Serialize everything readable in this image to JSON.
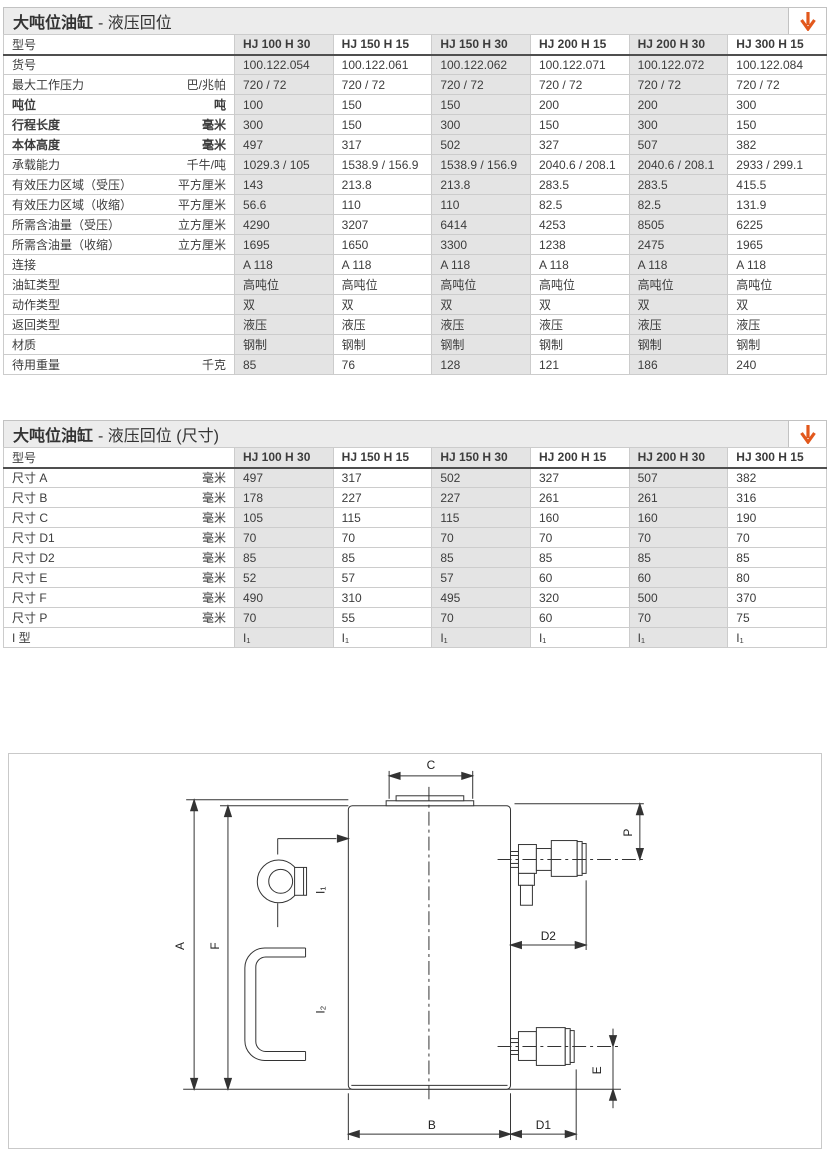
{
  "accent_orange": "#e2581c",
  "tables": [
    {
      "title_main": "大吨位油缸",
      "title_suffix": "- 液压回位",
      "model_header": "型号",
      "columns": [
        "HJ 100 H 30",
        "HJ 150 H 15",
        "HJ 150 H 30",
        "HJ 200 H 15",
        "HJ 200 H 30",
        "HJ 300 H 15"
      ],
      "rows": [
        {
          "label": "货号",
          "unit": "",
          "bold": false,
          "values": [
            "100.122.054",
            "100.122.061",
            "100.122.062",
            "100.122.071",
            "100.122.072",
            "100.122.084"
          ]
        },
        {
          "label": "最大工作压力",
          "unit": "巴/兆帕",
          "bold": false,
          "values": [
            "720 / 72",
            "720 / 72",
            "720 / 72",
            "720 / 72",
            "720 / 72",
            "720 / 72"
          ]
        },
        {
          "label": "吨位",
          "unit": "吨",
          "bold": true,
          "values": [
            "100",
            "150",
            "150",
            "200",
            "200",
            "300"
          ]
        },
        {
          "label": "行程长度",
          "unit": "毫米",
          "bold": true,
          "values": [
            "300",
            "150",
            "300",
            "150",
            "300",
            "150"
          ]
        },
        {
          "label": "本体高度",
          "unit": "毫米",
          "bold": true,
          "values": [
            "497",
            "317",
            "502",
            "327",
            "507",
            "382"
          ]
        },
        {
          "label": "承载能力",
          "unit": "千牛/吨",
          "bold": false,
          "values": [
            "1029.3 / 105",
            "1538.9 / 156.9",
            "1538.9 / 156.9",
            "2040.6 / 208.1",
            "2040.6 / 208.1",
            "2933 / 299.1"
          ]
        },
        {
          "label": "有效压力区域（受压）",
          "unit": "平方厘米",
          "bold": false,
          "values": [
            "143",
            "213.8",
            "213.8",
            "283.5",
            "283.5",
            "415.5"
          ]
        },
        {
          "label": "有效压力区域（收缩）",
          "unit": "平方厘米",
          "bold": false,
          "values": [
            "56.6",
            "110",
            "110",
            "82.5",
            "82.5",
            "131.9"
          ]
        },
        {
          "label": "所需含油量（受压）",
          "unit": "立方厘米",
          "bold": false,
          "values": [
            "4290",
            "3207",
            "6414",
            "4253",
            "8505",
            "6225"
          ]
        },
        {
          "label": "所需含油量（收缩）",
          "unit": "立方厘米",
          "bold": false,
          "values": [
            "1695",
            "1650",
            "3300",
            "1238",
            "2475",
            "1965"
          ]
        },
        {
          "label": "连接",
          "unit": "",
          "bold": false,
          "values": [
            "A 118",
            "A 118",
            "A 118",
            "A 118",
            "A 118",
            "A 118"
          ]
        },
        {
          "label": "油缸类型",
          "unit": "",
          "bold": false,
          "values": [
            "高吨位",
            "高吨位",
            "高吨位",
            "高吨位",
            "高吨位",
            "高吨位"
          ]
        },
        {
          "label": "动作类型",
          "unit": "",
          "bold": false,
          "values": [
            "双",
            "双",
            "双",
            "双",
            "双",
            "双"
          ]
        },
        {
          "label": "返回类型",
          "unit": "",
          "bold": false,
          "values": [
            "液压",
            "液压",
            "液压",
            "液压",
            "液压",
            "液压"
          ]
        },
        {
          "label": "材质",
          "unit": "",
          "bold": false,
          "values": [
            "钢制",
            "钢制",
            "钢制",
            "钢制",
            "钢制",
            "钢制"
          ]
        },
        {
          "label": "待用重量",
          "unit": "千克",
          "bold": false,
          "values": [
            "85",
            "76",
            "128",
            "121",
            "186",
            "240"
          ]
        }
      ]
    },
    {
      "title_main": "大吨位油缸",
      "title_suffix": "- 液压回位 (尺寸)",
      "model_header": "型号",
      "columns": [
        "HJ 100 H 30",
        "HJ 150 H 15",
        "HJ 150 H 30",
        "HJ 200 H 15",
        "HJ 200 H 30",
        "HJ 300 H 15"
      ],
      "rows": [
        {
          "label": "尺寸 A",
          "unit": "毫米",
          "bold": false,
          "values": [
            "497",
            "317",
            "502",
            "327",
            "507",
            "382"
          ]
        },
        {
          "label": "尺寸 B",
          "unit": "毫米",
          "bold": false,
          "values": [
            "178",
            "227",
            "227",
            "261",
            "261",
            "316"
          ]
        },
        {
          "label": "尺寸 C",
          "unit": "毫米",
          "bold": false,
          "values": [
            "105",
            "115",
            "115",
            "160",
            "160",
            "190"
          ]
        },
        {
          "label": "尺寸 D1",
          "unit": "毫米",
          "bold": false,
          "values": [
            "70",
            "70",
            "70",
            "70",
            "70",
            "70"
          ]
        },
        {
          "label": "尺寸 D2",
          "unit": "毫米",
          "bold": false,
          "values": [
            "85",
            "85",
            "85",
            "85",
            "85",
            "85"
          ]
        },
        {
          "label": "尺寸 E",
          "unit": "毫米",
          "bold": false,
          "values": [
            "52",
            "57",
            "57",
            "60",
            "60",
            "80"
          ]
        },
        {
          "label": "尺寸 F",
          "unit": "毫米",
          "bold": false,
          "values": [
            "490",
            "310",
            "495",
            "320",
            "500",
            "370"
          ]
        },
        {
          "label": "尺寸 P",
          "unit": "毫米",
          "bold": false,
          "values": [
            "70",
            "55",
            "70",
            "60",
            "70",
            "75"
          ]
        },
        {
          "label": "I 型",
          "unit": "",
          "bold": false,
          "values": [
            "I₁",
            "I₁",
            "I₁",
            "I₁",
            "I₁",
            "I₁"
          ]
        }
      ]
    }
  ],
  "diagram": {
    "labels": {
      "A": "A",
      "F": "F",
      "C": "C",
      "P": "P",
      "D2": "D2",
      "E": "E",
      "B": "B",
      "D1": "D1",
      "I1": "I₁",
      "I2": "I₂"
    }
  }
}
